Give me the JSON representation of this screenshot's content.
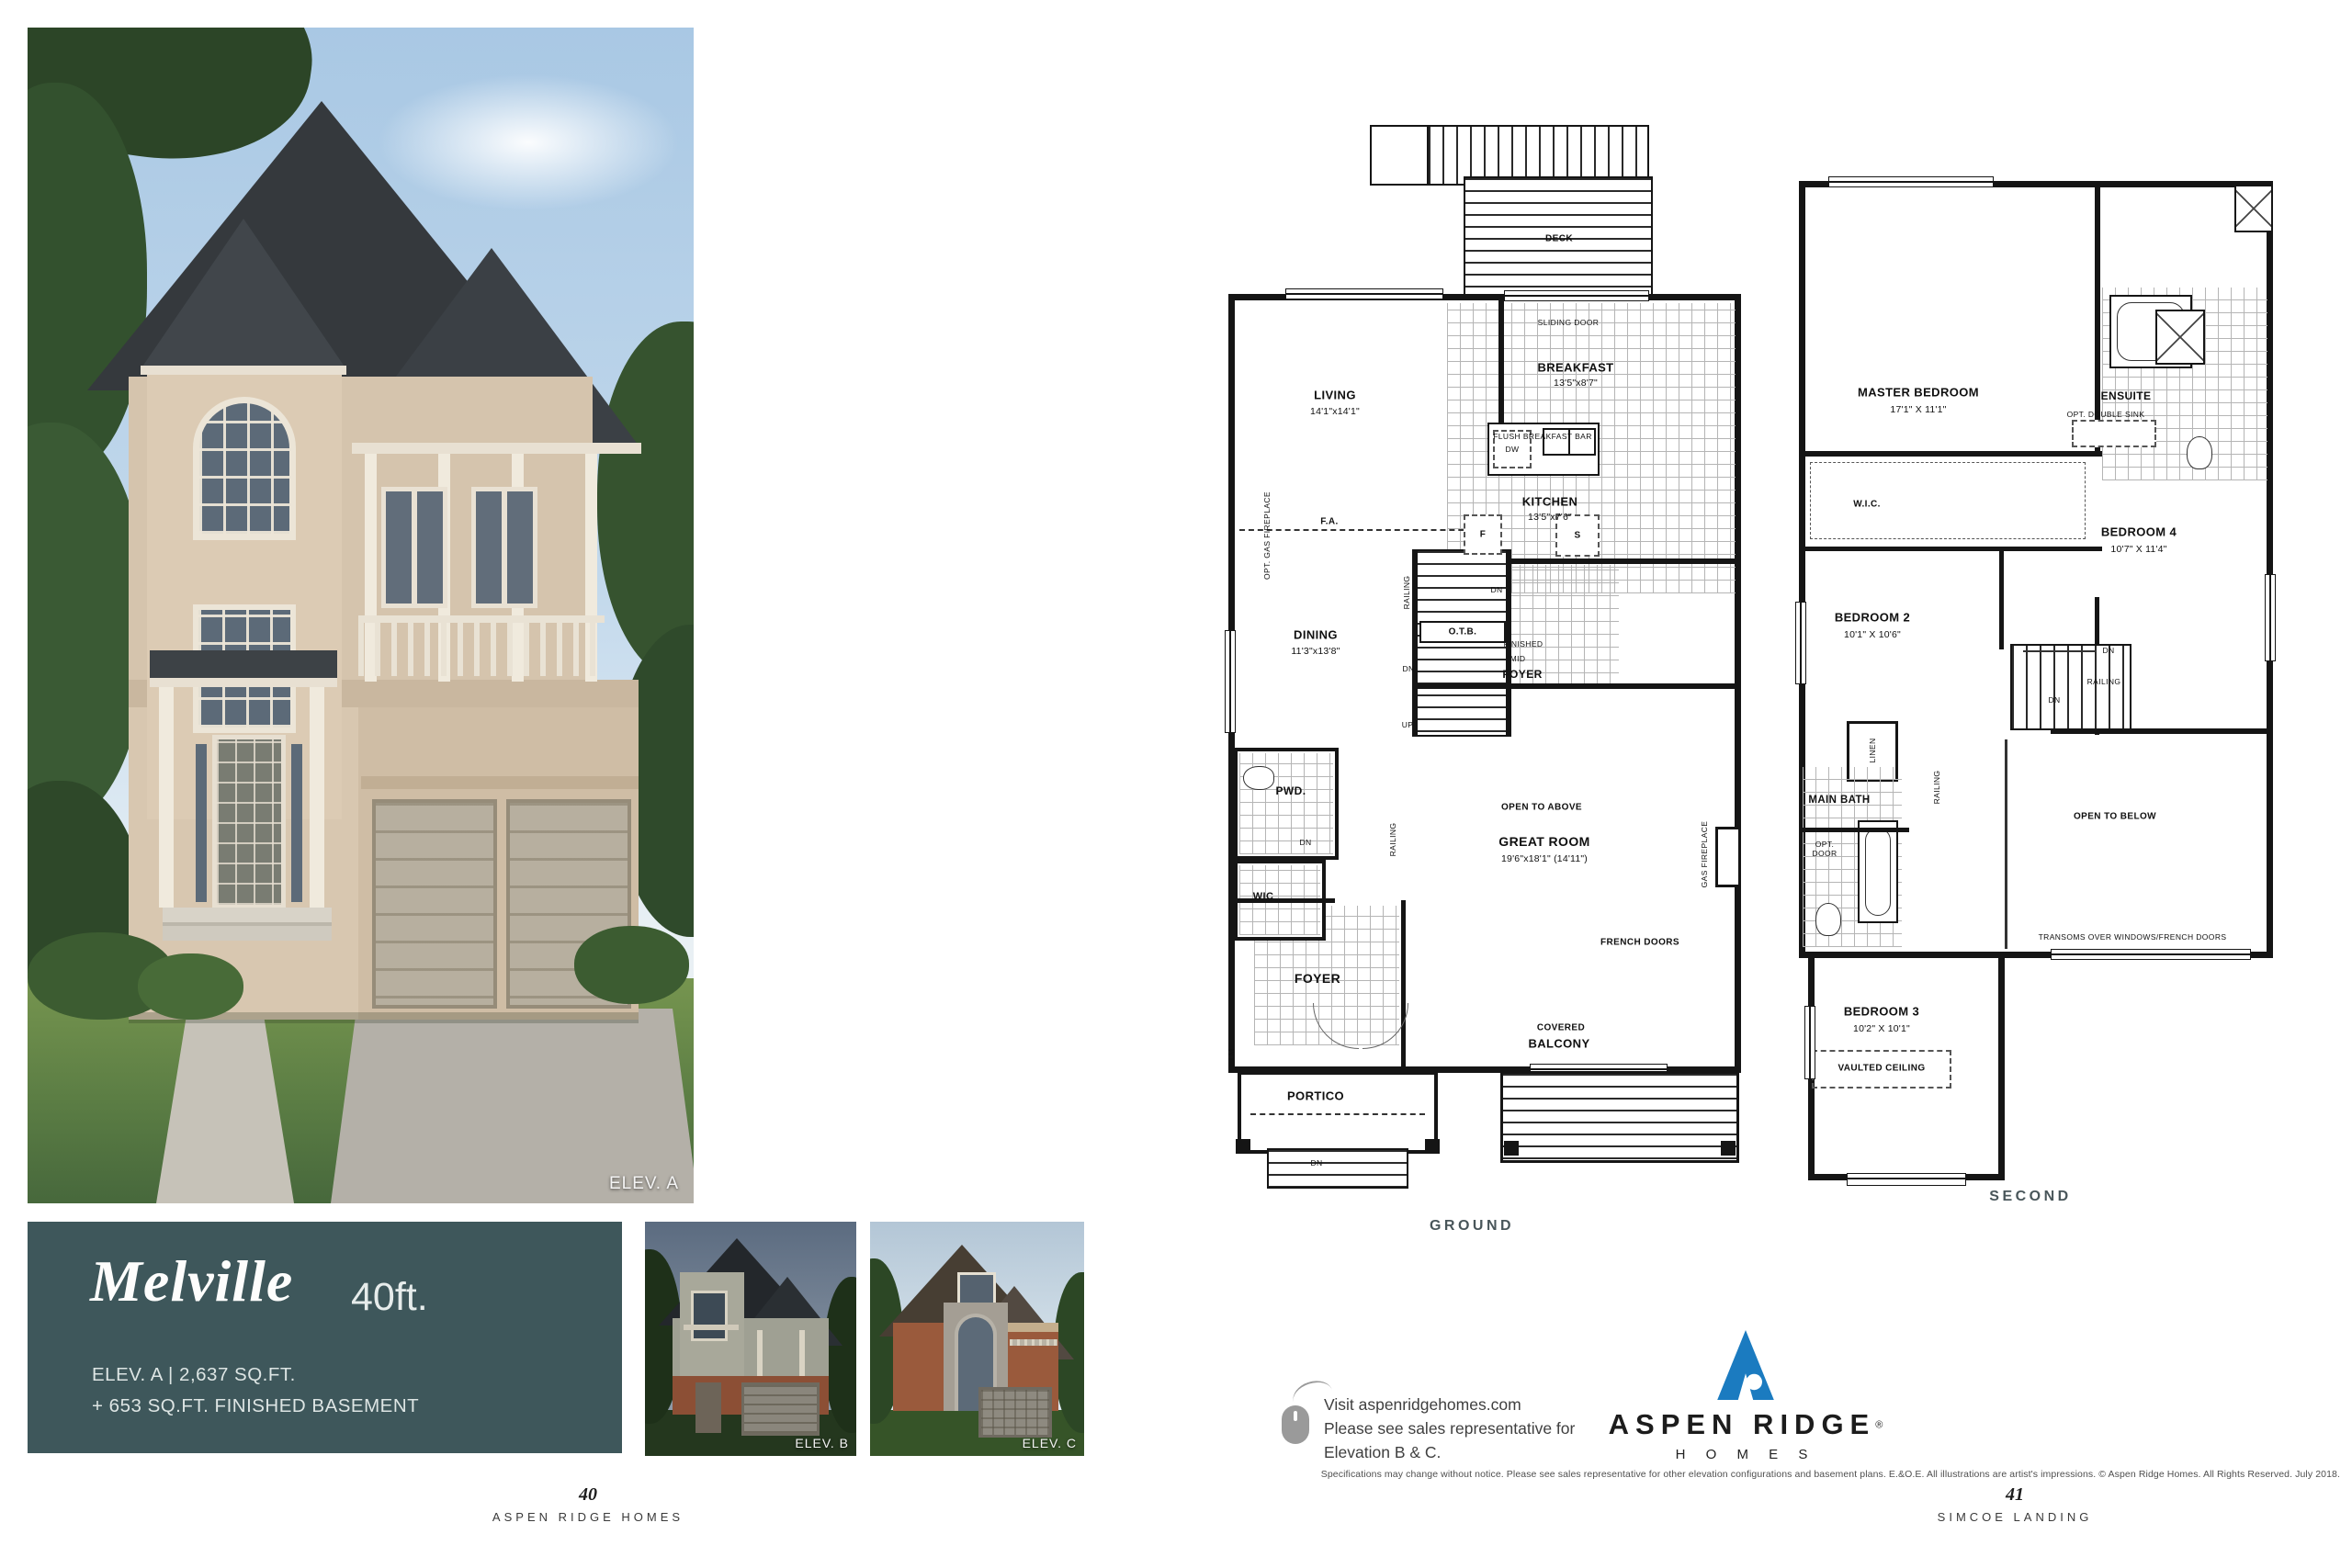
{
  "colors": {
    "teal_panel": "#3e575b",
    "logo_blue": "#1b7bc0",
    "plan_ink": "#151515"
  },
  "hero": {
    "elevation_label": "ELEV. A"
  },
  "title_box": {
    "name": "Melville",
    "size": "40ft.",
    "spec1": "ELEV. A  |  2,637 SQ.FT.",
    "spec2": "+ 653 SQ.FT. FINISHED BASEMENT"
  },
  "thumbs": [
    {
      "label": "ELEV. B"
    },
    {
      "label": "ELEV. C"
    }
  ],
  "footer_left": {
    "page": "40",
    "name": "ASPEN RIDGE HOMES"
  },
  "footer_right": {
    "page": "41",
    "name": "SIMCOE LANDING"
  },
  "promo": {
    "line1": "Visit aspenridgehomes.com",
    "line2": "Please see sales representative for",
    "line3": "Elevation B & C."
  },
  "logo": {
    "brand": "ASPEN RIDGE",
    "reg": "®",
    "homes": "H O M E S"
  },
  "disclaimer": "Specifications may change without notice. Please see sales representative for other elevation configurations and basement plans. E.&O.E. All illustrations are artist's impressions. © Aspen Ridge Homes. All Rights Reserved. July 2018.",
  "ground_plan": {
    "title": "GROUND",
    "rooms": {
      "deck": "DECK",
      "sliding_door": "SLIDING DOOR",
      "breakfast": "BREAKFAST",
      "breakfast_dims": "13'5\"x8'7\"",
      "living": "LIVING",
      "living_dims": "14'1\"x14'1\"",
      "opt_gas_fireplace": "OPT. GAS FIREPLACE",
      "flush_breakfast_bar": "FLUSH BREAKFAST BAR",
      "dw": "DW",
      "kitchen": "KITCHEN",
      "kitchen_dims": "13'5\"x7'6\"",
      "fridge": "F",
      "stove": "S",
      "fa": "F.A.",
      "dining": "DINING",
      "dining_dims": "11'3\"x13'8\"",
      "railing": "RAILING",
      "otb": "O.T.B.",
      "dn": "DN",
      "up": "UP",
      "finished": "FINISHED",
      "mid": "MID",
      "foyer_mid": "FOYER",
      "pwd": "PWD.",
      "wic": "WIC",
      "foyer": "FOYER",
      "open_above": "OPEN TO ABOVE",
      "great_room": "GREAT ROOM",
      "great_room_dims": "19'6\"x18'1\" (14'11\")",
      "gas_fireplace": "GAS FIREPLACE",
      "french_doors": "FRENCH DOORS",
      "covered": "COVERED",
      "balcony": "BALCONY",
      "portico": "PORTICO",
      "lm": "LM"
    }
  },
  "second_plan": {
    "title": "SECOND",
    "rooms": {
      "master": "MASTER BEDROOM",
      "master_dims": "17'1\" X 11'1\"",
      "ensuite": "ENSUITE",
      "opt_double_sink": "OPT. DOUBLE SINK",
      "wic": "W.I.C.",
      "bed4": "BEDROOM 4",
      "bed4_dims": "10'7\" X 11'4\"",
      "bed2": "BEDROOM 2",
      "bed2_dims": "10'1\" X 10'6\"",
      "dn": "DN",
      "railing": "RAILING",
      "linen": "LINEN",
      "main_bath": "MAIN BATH",
      "opt": "OPT.",
      "door": "DOOR",
      "open_below": "OPEN TO BELOW",
      "transoms": "TRANSOMS OVER WINDOWS/FRENCH DOORS",
      "bed3": "BEDROOM 3",
      "bed3_dims": "10'2\" X 10'1\"",
      "vaulted": "VAULTED CEILING"
    }
  }
}
